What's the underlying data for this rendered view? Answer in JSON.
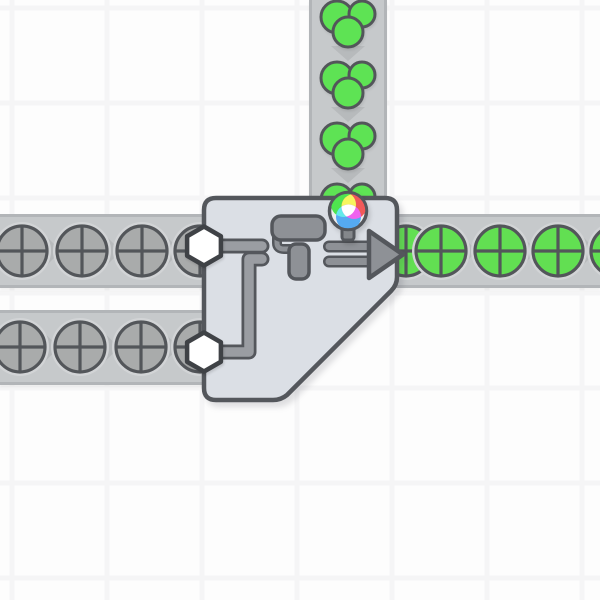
{
  "app": {
    "title": "factory-automation-game-scene",
    "scene_description": "double painter building painting uncolored circle shapes green"
  },
  "colors": {
    "background": "#fdfdfd",
    "grid_line": "#f5f5f6",
    "belt_fill": "#c6c9cb",
    "belt_edge": "#b2b5b8",
    "belt_chevron": "#b7babc",
    "item_shadow": "#d2d4d6",
    "shape_outline": "#53565a",
    "uncolored_fill": "#a9abab",
    "green_fill": "#62df52",
    "cluster_green": "#5ee354",
    "building_fill": "#dbdfe5",
    "building_outline": "#54575c",
    "pipe_fill": "#9a9da2",
    "icon_fill": "#8e9196",
    "hexagon_fill": "#ffffff",
    "hexagon_outline": "#3f4246",
    "pin_base": "#eeeeee",
    "pin_stem": "#84878b",
    "pin_red": "#f15959",
    "pin_green": "#4fe44f",
    "pin_blue": "#55aaf1",
    "pin_yellow": "#f6f65e",
    "pin_cyan": "#63eaea",
    "pin_magenta": "#ef63ef",
    "pin_white": "#ffffff"
  },
  "grid": {
    "spacing": 95,
    "offset_x": 12,
    "offset_y": 8,
    "line_width": 5
  },
  "belts": [
    {
      "name": "conveyor-color-input-vertical",
      "orientation": "vertical",
      "direction": "down",
      "x": 309,
      "y": 0,
      "width": 78,
      "height": 198,
      "chevrons": [
        46,
        107,
        168
      ],
      "item_type": "color-green",
      "items": [
        {
          "x": 348,
          "y": 23
        },
        {
          "x": 348,
          "y": 84
        },
        {
          "x": 348,
          "y": 145
        },
        {
          "x": 348,
          "y": 206
        }
      ]
    },
    {
      "name": "conveyor-input-upper",
      "orientation": "horizontal",
      "direction": "right",
      "x": 0,
      "y": 214,
      "width": 206,
      "height": 74,
      "chevrons": [
        52,
        112,
        172
      ],
      "item_type": "circle-uncolored",
      "items": [
        {
          "x": 22,
          "y": 251
        },
        {
          "x": 82,
          "y": 251
        },
        {
          "x": 142,
          "y": 251
        },
        {
          "x": 200,
          "y": 251
        }
      ]
    },
    {
      "name": "conveyor-input-lower",
      "orientation": "horizontal",
      "direction": "right",
      "x": 0,
      "y": 310,
      "width": 206,
      "height": 75,
      "chevrons": [
        50,
        110,
        170
      ],
      "item_type": "circle-uncolored",
      "items": [
        {
          "x": 20,
          "y": 347
        },
        {
          "x": 80,
          "y": 347
        },
        {
          "x": 141,
          "y": 347
        },
        {
          "x": 200,
          "y": 347
        }
      ]
    },
    {
      "name": "conveyor-output-right",
      "orientation": "horizontal",
      "direction": "right",
      "x": 395,
      "y": 214,
      "width": 205,
      "height": 74,
      "chevrons": [
        468,
        528,
        588
      ],
      "item_type": "circle-green",
      "items": [
        {
          "x": 406,
          "y": 251
        },
        {
          "x": 441,
          "y": 251
        },
        {
          "x": 500,
          "y": 251
        },
        {
          "x": 558,
          "y": 251
        },
        {
          "x": 616,
          "y": 251
        }
      ]
    }
  ],
  "item_geometry": {
    "shape_radius": 25,
    "shadow_radius": 29,
    "cluster_circles": [
      {
        "dx": -11,
        "dy": -6,
        "r": 16
      },
      {
        "dx": 14,
        "dy": -9,
        "r": 13
      },
      {
        "dx": 0,
        "dy": 9,
        "r": 15
      }
    ]
  },
  "building": {
    "name": "double-painter",
    "body_path": "M 216 198 L 385 198 Q 397 198 397 210 L 397 277 Q 397 285 391 291 L 287 395 Q 281 400 273 400 L 216 400 Q 204 400 204 388 L 204 210 Q 204 198 216 198 Z",
    "pipes": [
      "M 208 246 L 262 246",
      "M 208 352 L 249 352 L 249 259 L 262 259"
    ],
    "input_connectors": [
      {
        "x": 204,
        "y": 246
      },
      {
        "x": 204,
        "y": 352
      }
    ],
    "hexagon_radius": 19.5,
    "paint_roller": {
      "arm_path": "M 277 237 L 277 243 Q 277 249 284 249 L 292 249",
      "handle": {
        "x": 289,
        "y": 244,
        "w": 20,
        "h": 35,
        "rx": 7
      },
      "body": {
        "x": 272,
        "y": 216,
        "w": 53,
        "h": 24,
        "rx": 9
      }
    },
    "output_arrow": {
      "bars": [
        "M 329 246.5 L 371 246.5",
        "M 329 261.5 L 371 261.5"
      ],
      "head_points": "369,231 403,254.5 369,278"
    },
    "color_indicator": {
      "current_color": "green",
      "x": 348,
      "y": 211,
      "radius": 18.5,
      "mix_radius": 12.5,
      "stem": {
        "x": 342,
        "y": 224,
        "w": 12,
        "h": 16,
        "rx": 3
      },
      "mix_circles": [
        {
          "dx": -4.5,
          "dy": -6.5,
          "color": "green"
        },
        {
          "dx": 6,
          "dy": -4.5,
          "color": "red"
        },
        {
          "dx": 0.5,
          "dy": 6,
          "color": "blue"
        }
      ]
    }
  }
}
